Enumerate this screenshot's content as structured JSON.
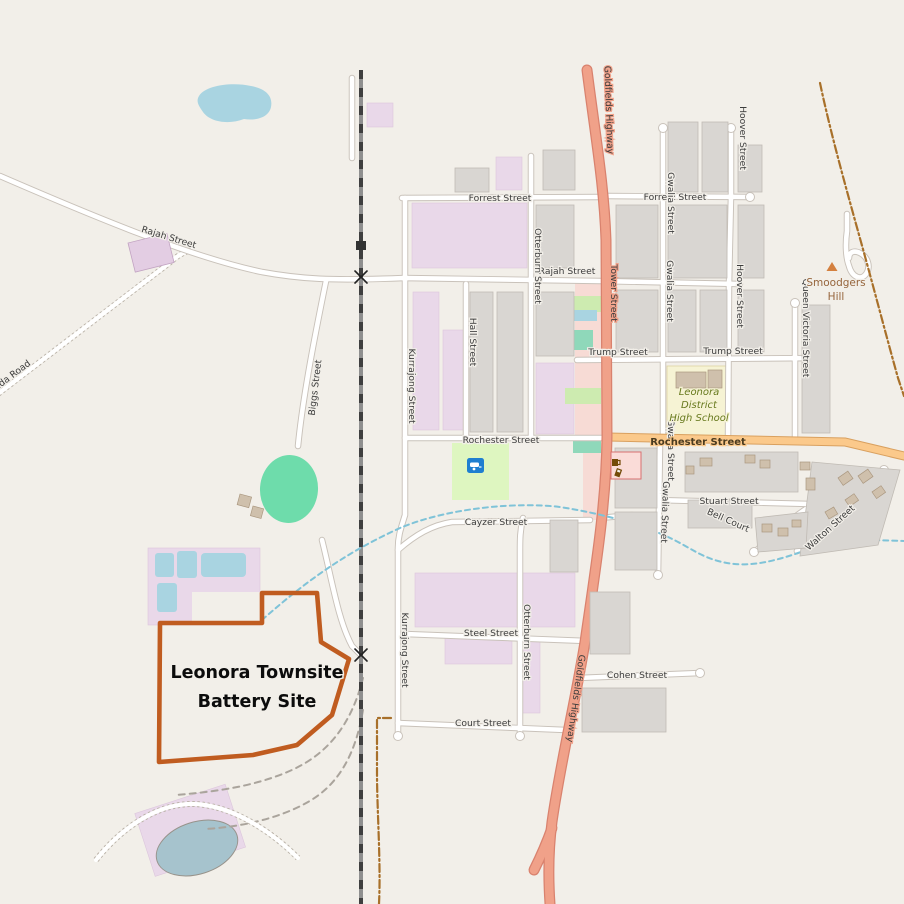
{
  "map": {
    "title": "Leonora Townsite Battery Site map",
    "site": {
      "label_line1": "Leonora Townsite",
      "label_line2": "Battery Site"
    },
    "streets": {
      "forrest": "Forrest Street",
      "rajah": "Rajah Street",
      "mount_ida": "Leonora - Mount Ida Road",
      "biggs": "Biggs Street",
      "kurrajong": "Kurrajong Street",
      "hall": "Hall Street",
      "otterburn": "Otterburn Street",
      "tower": "Tower Street",
      "goldfields": "Goldfields Highway",
      "trump": "Trump Street",
      "gwalia": "Gwalia Street",
      "hoover": "Hoover Street",
      "queen_victoria": "Queen Victoria Street",
      "rochester": "Rochester Street",
      "cayzer": "Cayzer Street",
      "steel": "Steel Street",
      "cohen": "Cohen Street",
      "court": "Court Street",
      "stuart": "Stuart Street",
      "bell": "Bell Court",
      "walton": "Walton Street"
    },
    "places": {
      "smoodgers_line1": "Smoodgers",
      "smoodgers_line2": "Hill",
      "school_line1": "Leonora",
      "school_line2": "District",
      "school_line3": "High School"
    },
    "icons": {
      "peak": "peak-icon",
      "caravan": "caravan-site-icon",
      "pub": "pub-icon",
      "fuel": "fuel-icon",
      "crossing": "railway-crossing-icon"
    },
    "colors": {
      "land": "#f2efe9",
      "water": "#a9d4e1",
      "building": "#d9d6d2",
      "residential_lilac": "#e9d8e9",
      "residential_pink": "#f7dbd5",
      "school": "#f6f3d4",
      "grass": "#cdebb0",
      "pitch": "#6edcab",
      "camp": "#def6c0",
      "trunk": "#f0a189",
      "primary": "#fbc98b",
      "casing": "#c9c2ba",
      "rail": "#3f3f3f",
      "stream": "#7fc3d8",
      "track": "#a8702a",
      "battery": "#c05c20",
      "label": "#3c3c3c"
    }
  }
}
